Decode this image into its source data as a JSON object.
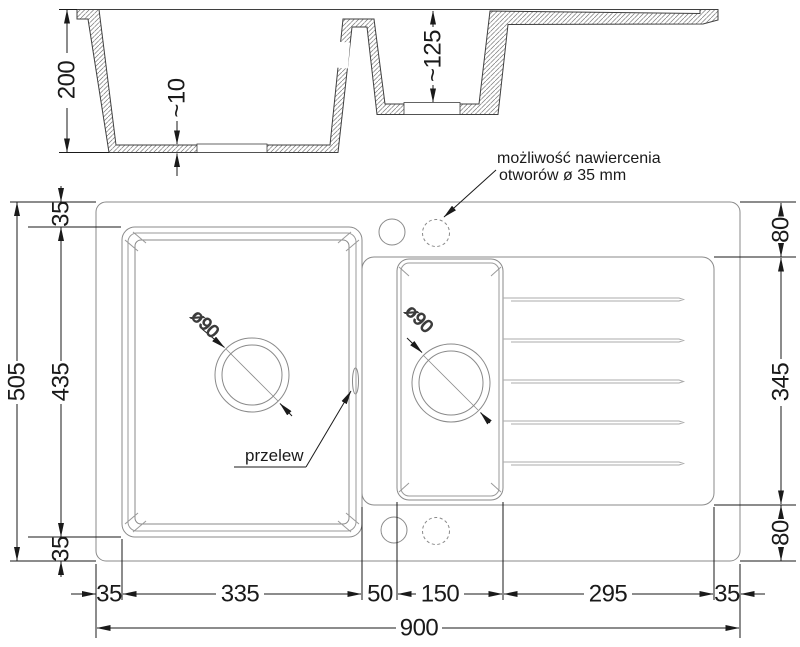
{
  "section": {
    "depth_main": "200",
    "floor_thickness": "~10",
    "depth_small": "~125"
  },
  "plan": {
    "height_total": "505",
    "height_basin": "435",
    "rim_top": "35",
    "rim_bottom": "35",
    "right_top": "80",
    "right_middle": "345",
    "right_bottom": "80",
    "bottom_chain": [
      "35",
      "335",
      "50",
      "150",
      "295",
      "35"
    ],
    "width_total": "900",
    "drain_main_dia": "ø90",
    "drain_small_dia": "ø90"
  },
  "labels": {
    "drill_line1": "możliwość nawiercenia",
    "drill_line2": "otworów ø 35 mm",
    "overflow": "przelew"
  },
  "colors": {
    "geometry": "#8a8a8a",
    "dimension": "#1a1a1a"
  }
}
